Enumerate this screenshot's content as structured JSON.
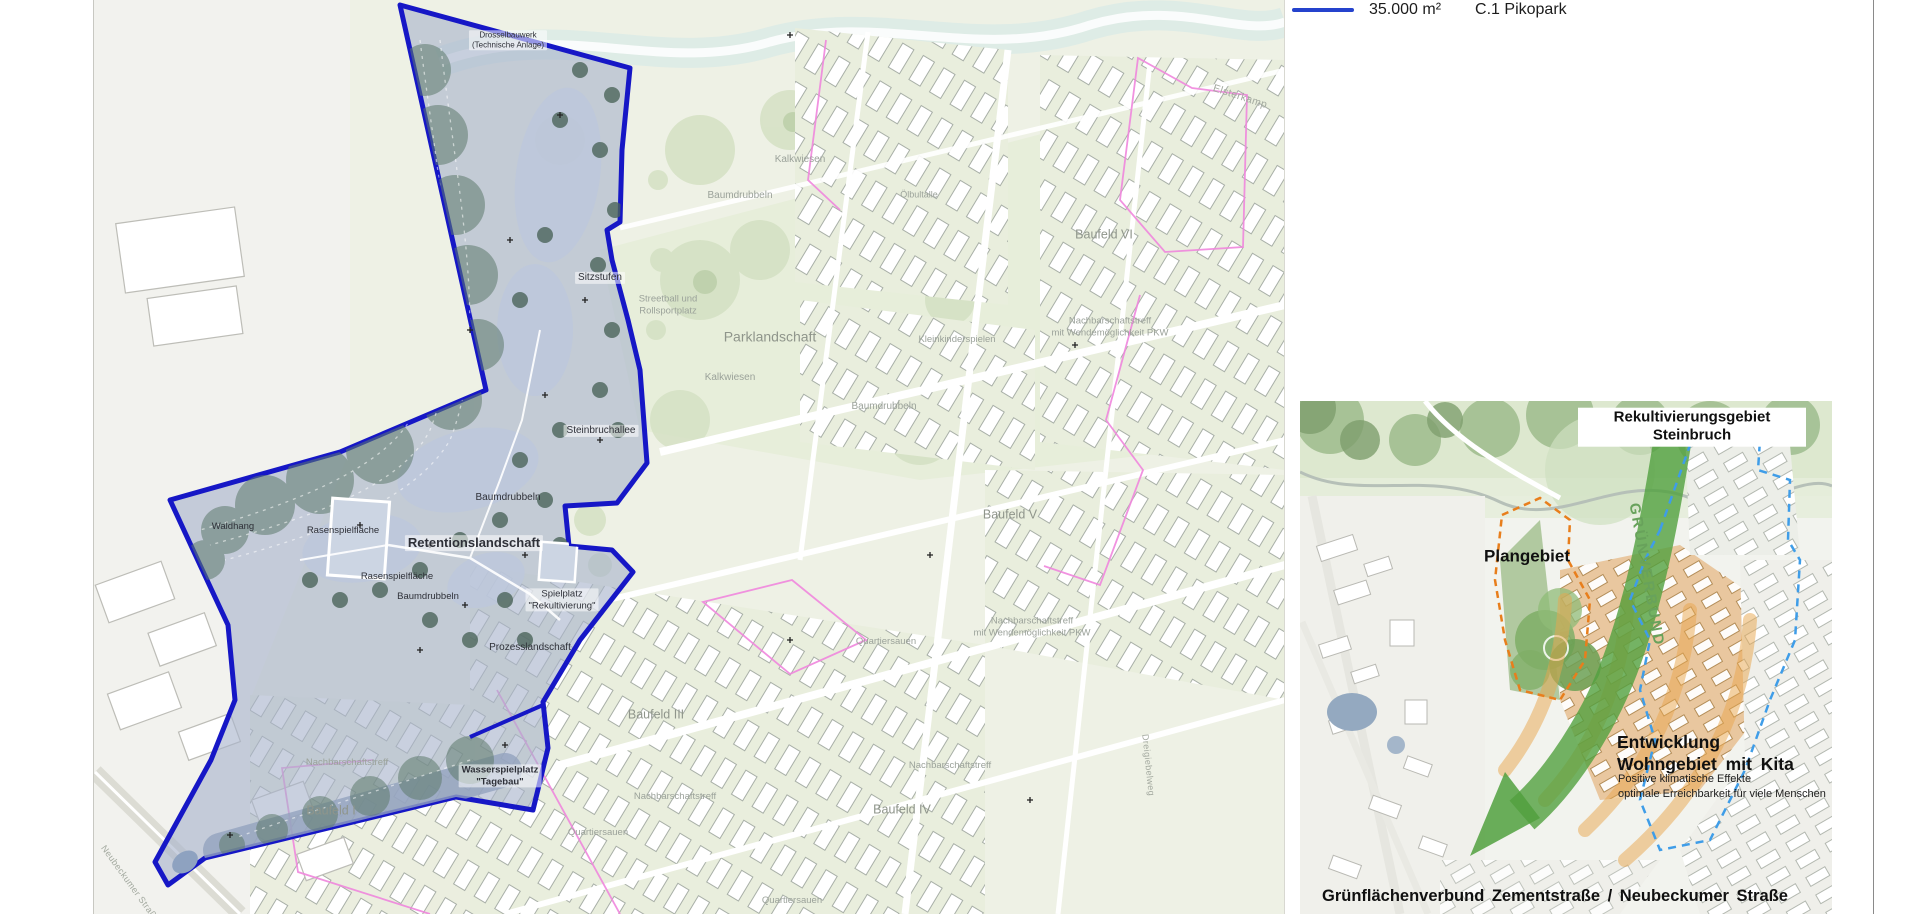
{
  "legend": {
    "area": "35.000 m²",
    "name": "C.1 Pikopark"
  },
  "colors": {
    "pikopark_outline": "#1617c6",
    "legend_line": "#2543cd",
    "boundary_magenta": "#ef86dd",
    "inset_arrow_green": "#51a03e",
    "inset_arc_orange": "#e9a74e",
    "boundary_blue_dashed": "#3f9de8",
    "boundary_orange_dashed": "#e87e1c"
  },
  "map_labels": {
    "drosselbauwerk": "Drosselbauwerk\n(Technische Anlage)",
    "sitzstufen": "Sitzstufen",
    "steinbruchallee": "Steinbruchallee",
    "baumdrubbeln_1": "Baumdrubbeln",
    "retentionslandschaft": "Retentionslandschaft",
    "waldhang": "Waldhang",
    "rasenspielflaeche_1": "Rasenspielfläche",
    "rasenspielflaeche_2": "Rasenspielfläche",
    "baumdrubbeln_2": "Baumdrubbeln",
    "spielplatz_rekultivierung": "Spielplatz\n\"Rekultivierung\"",
    "prozesslandschaft": "Prozesslandschaft",
    "wasserspielplatz_tagebau": "Wasserspielplatz\n\"Tagebau\"",
    "parklandschaft": "Parklandschaft",
    "kalkwiesen_1": "Kalkwiesen",
    "kalkwiesen_2": "Kalkwiesen",
    "baumdrubbeln_3": "Baumdrubbeln",
    "baumdrubbeln_4": "Baumdrubbeln",
    "oelbultalle": "Ölbultalle",
    "streetball": "Streetball und\nRollsportplatz",
    "kleinkinderspielen": "Kleinkinderspielen",
    "nachbarschaftstreff_pkw_1": "Nachbarschaftstreff\nmit Wendemöglichkeit PKW",
    "nachbarschaftstreff_pkw_2": "Nachbarschaftstreff\nmit Wendemöglichkeit PKW",
    "nachbarschaftstreff_1": "Nachbarschaftstreff",
    "nachbarschaftstreff_2": "Nachbarschaftstreff",
    "nachbarschaftstreff_3": "Nachbarschaftstreff",
    "quartiersauen_1": "Quartiersauen",
    "quartiersauen_2": "Quartiersauen",
    "quartiersauen_3": "Quartiersauen",
    "baufeld_i": "Baufeld I",
    "baufeld_iii": "Baufeld III",
    "baufeld_iv": "Baufeld IV",
    "baufeld_v": "Baufeld V",
    "baufeld_vi": "Baufeld VI",
    "elsterkamp": "Elsterkamp",
    "neubeckumer_strasse": "Neubeckumer Straße",
    "dreigiebelweg": "Dreigiebelweg"
  },
  "inset": {
    "title": "Rekultivierungsgebiet Steinbruch",
    "plangebiet": "Plangebiet",
    "gruenverbund": "GRÜNVERBUND",
    "entwicklung": "Entwicklung\nWohngebiet mit Kita",
    "effekte": "Positive klimatische Effekte\noptimale Erreichbarkeit für viele Menschen",
    "caption": "Grünflächenverbund Zementstraße / Neubeckumer Straße"
  }
}
